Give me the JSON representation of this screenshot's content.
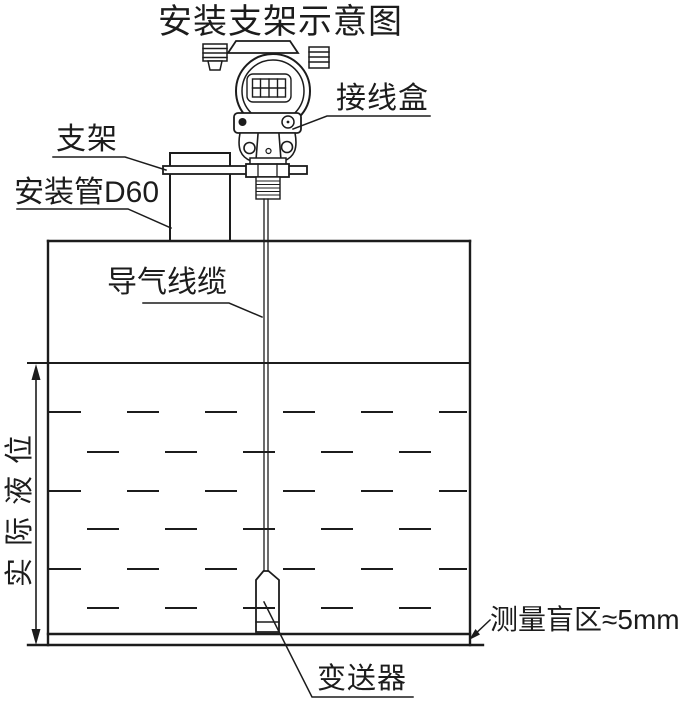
{
  "title": "安装支架示意图",
  "labels": {
    "junction_box": "接线盒",
    "bracket": "支架",
    "mounting_pipe": "安装管D60",
    "air_cable": "导气线缆",
    "actual_level": "实际液位",
    "blind_zone": "测量盲区≈5mm",
    "transmitter": "变送器"
  },
  "colors": {
    "ink": "#1c1c1c",
    "background": "#ffffff"
  }
}
